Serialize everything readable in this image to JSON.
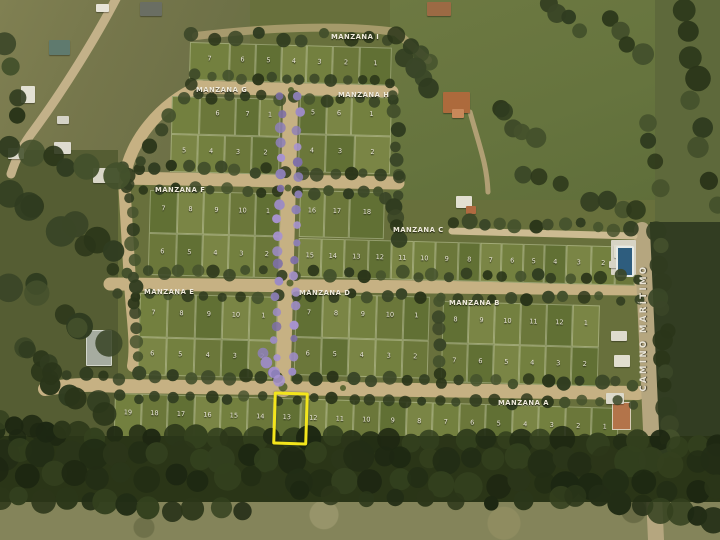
{
  "road": {
    "label": "CAMINO MARÍTIMO"
  },
  "highlight": {
    "block": "MANZANA A",
    "lot": "13",
    "color": "#F3E51C"
  },
  "palette": {
    "road": "#c6b183",
    "lawn": "#73803f",
    "trees": "#303c20",
    "flowering_trees": "#9c8bc4",
    "highlight": "#F3E51C"
  },
  "blocks": [
    {
      "name": "MANZANA A",
      "lx": 498,
      "ly": 399,
      "x": 115,
      "y": 393,
      "w": 504,
      "h": 45,
      "rot": 1.7,
      "rows": [
        {
          "y": 0,
          "h": 45,
          "cells": [
            {
              "n": "19",
              "x": 0,
              "w": 27
            },
            {
              "n": "18",
              "x": 27,
              "w": 26
            },
            {
              "n": "17",
              "x": 53,
              "w": 27
            },
            {
              "n": "16",
              "x": 80,
              "w": 26
            },
            {
              "n": "15",
              "x": 106,
              "w": 27
            },
            {
              "n": "14",
              "x": 133,
              "w": 26
            },
            {
              "n": "13",
              "x": 159,
              "w": 27,
              "hl": true
            },
            {
              "n": "12",
              "x": 186,
              "w": 26
            },
            {
              "n": "11",
              "x": 212,
              "w": 27
            },
            {
              "n": "10",
              "x": 239,
              "w": 26
            },
            {
              "n": "9",
              "x": 265,
              "w": 27
            },
            {
              "n": "8",
              "x": 292,
              "w": 26
            },
            {
              "n": "7",
              "x": 318,
              "w": 27
            },
            {
              "n": "6",
              "x": 345,
              "w": 26
            },
            {
              "n": "5",
              "x": 371,
              "w": 27
            },
            {
              "n": "4",
              "x": 398,
              "w": 26
            },
            {
              "n": "3",
              "x": 424,
              "w": 27
            },
            {
              "n": "2",
              "x": 451,
              "w": 26
            },
            {
              "n": "1",
              "x": 477,
              "w": 27
            }
          ]
        }
      ]
    },
    {
      "name": "MANZANA B",
      "lx": 449,
      "ly": 299,
      "x": 443,
      "y": 301,
      "w": 157,
      "h": 81,
      "rot": 1.6,
      "rows": [
        {
          "y": 0,
          "h": 42,
          "cells": [
            {
              "n": "8",
              "x": 0,
              "w": 26
            },
            {
              "n": "9",
              "x": 26,
              "w": 26
            },
            {
              "n": "10",
              "x": 52,
              "w": 26
            },
            {
              "n": "11",
              "x": 78,
              "w": 26
            },
            {
              "n": "12",
              "x": 104,
              "w": 26
            },
            {
              "n": "1",
              "x": 130,
              "w": 27
            }
          ]
        },
        {
          "y": 42,
          "h": 39,
          "cells": [
            {
              "n": "7",
              "x": 0,
              "w": 26
            },
            {
              "n": "6",
              "x": 26,
              "w": 26
            },
            {
              "n": "5",
              "x": 52,
              "w": 26
            },
            {
              "n": "4",
              "x": 78,
              "w": 26
            },
            {
              "n": "3",
              "x": 104,
              "w": 26
            },
            {
              "n": "2",
              "x": 130,
              "w": 27
            }
          ]
        }
      ]
    },
    {
      "name": "MANZANA C",
      "lx": 393,
      "ly": 226,
      "x": 300,
      "y": 190,
      "w": 337,
      "h": 87,
      "rot": 1.5,
      "rows": [
        {
          "y": 0,
          "h": 47,
          "cells": [
            {
              "n": "16",
              "x": 0,
              "w": 25
            },
            {
              "n": "17",
              "x": 25,
              "w": 25
            },
            {
              "n": "18",
              "x": 50,
              "w": 35
            }
          ]
        },
        {
          "y": 48,
          "h": 39,
          "cells": [
            {
              "n": "15",
              "x": 0,
              "w": 23
            },
            {
              "n": "14",
              "x": 23,
              "w": 23
            },
            {
              "n": "13",
              "x": 46,
              "w": 24
            },
            {
              "n": "12",
              "x": 70,
              "w": 23
            },
            {
              "n": "11",
              "x": 93,
              "w": 22
            },
            {
              "n": "10",
              "x": 115,
              "w": 22
            },
            {
              "n": "9",
              "x": 137,
              "w": 23
            },
            {
              "n": "8",
              "x": 160,
              "w": 22
            },
            {
              "n": "7",
              "x": 182,
              "w": 21
            },
            {
              "n": "6",
              "x": 203,
              "w": 22
            },
            {
              "n": "5",
              "x": 225,
              "w": 21
            },
            {
              "n": "4",
              "x": 246,
              "w": 22
            },
            {
              "n": "3",
              "x": 268,
              "w": 25
            },
            {
              "n": "2",
              "x": 293,
              "w": 24
            },
            {
              "n": "1",
              "x": 317,
              "w": 20
            }
          ]
        }
      ]
    },
    {
      "name": "MANZANA D",
      "lx": 299,
      "ly": 289,
      "x": 296,
      "y": 293,
      "w": 134,
      "h": 82,
      "rot": 1.6,
      "rows": [
        {
          "y": 0,
          "h": 44,
          "cells": [
            {
              "n": "7",
              "x": 0,
              "w": 27
            },
            {
              "n": "8",
              "x": 27,
              "w": 27
            },
            {
              "n": "9",
              "x": 54,
              "w": 27
            },
            {
              "n": "10",
              "x": 81,
              "w": 27
            },
            {
              "n": "1",
              "x": 108,
              "w": 26
            }
          ]
        },
        {
          "y": 44,
          "h": 38,
          "cells": [
            {
              "n": "6",
              "x": 0,
              "w": 27
            },
            {
              "n": "5",
              "x": 27,
              "w": 27
            },
            {
              "n": "4",
              "x": 54,
              "w": 27
            },
            {
              "n": "3",
              "x": 81,
              "w": 27
            },
            {
              "n": "2",
              "x": 108,
              "w": 26
            }
          ]
        }
      ]
    },
    {
      "name": "MANZANA E",
      "lx": 144,
      "ly": 288,
      "x": 140,
      "y": 293,
      "w": 138,
      "h": 82,
      "rot": 1.6,
      "rows": [
        {
          "y": 0,
          "h": 44,
          "cells": [
            {
              "n": "7",
              "x": 0,
              "w": 28
            },
            {
              "n": "8",
              "x": 28,
              "w": 28
            },
            {
              "n": "9",
              "x": 56,
              "w": 27
            },
            {
              "n": "10",
              "x": 83,
              "w": 27
            },
            {
              "n": "1",
              "x": 110,
              "w": 28
            }
          ]
        },
        {
          "y": 44,
          "h": 38,
          "cells": [
            {
              "n": "6",
              "x": 0,
              "w": 28
            },
            {
              "n": "5",
              "x": 28,
              "w": 28
            },
            {
              "n": "4",
              "x": 56,
              "w": 27
            },
            {
              "n": "3",
              "x": 83,
              "w": 27
            },
            {
              "n": "2",
              "x": 110,
              "w": 28
            }
          ]
        }
      ]
    },
    {
      "name": "MANZANA F",
      "lx": 155,
      "ly": 186,
      "x": 150,
      "y": 190,
      "w": 131,
      "h": 85,
      "rot": 1.5,
      "rows": [
        {
          "y": 0,
          "h": 43,
          "cells": [
            {
              "n": "7",
              "x": 0,
              "w": 28
            },
            {
              "n": "8",
              "x": 28,
              "w": 26
            },
            {
              "n": "9",
              "x": 54,
              "w": 26
            },
            {
              "n": "10",
              "x": 80,
              "w": 26
            },
            {
              "n": "1",
              "x": 106,
              "w": 25
            }
          ]
        },
        {
          "y": 43,
          "h": 42,
          "cells": [
            {
              "n": "6",
              "x": 0,
              "w": 28
            },
            {
              "n": "5",
              "x": 28,
              "w": 26
            },
            {
              "n": "4",
              "x": 54,
              "w": 26
            },
            {
              "n": "3",
              "x": 80,
              "w": 26
            },
            {
              "n": "2",
              "x": 106,
              "w": 25
            }
          ]
        }
      ]
    },
    {
      "name": "MANZANA G",
      "lx": 196,
      "ly": 86,
      "x": 172,
      "y": 96,
      "w": 109,
      "h": 76,
      "rot": 1.5,
      "rows": [
        {
          "y": 0,
          "h": 38,
          "cells": [
            {
              "n": "",
              "x": 0,
              "w": 28
            },
            {
              "n": "6",
              "x": 28,
              "w": 36
            },
            {
              "n": "7",
              "x": 64,
              "w": 24
            },
            {
              "n": "1",
              "x": 88,
              "w": 21
            }
          ]
        },
        {
          "y": 38,
          "h": 38,
          "cells": [
            {
              "n": "5",
              "x": 0,
              "w": 27
            },
            {
              "n": "4",
              "x": 27,
              "w": 27
            },
            {
              "n": "3",
              "x": 54,
              "w": 27
            },
            {
              "n": "2",
              "x": 81,
              "w": 28
            }
          ]
        }
      ]
    },
    {
      "name": "MANZANA H",
      "lx": 338,
      "ly": 91,
      "x": 300,
      "y": 95,
      "w": 92,
      "h": 77,
      "rot": 1.5,
      "rows": [
        {
          "y": 0,
          "h": 39,
          "cells": [
            {
              "n": "5",
              "x": 0,
              "w": 27
            },
            {
              "n": "6",
              "x": 27,
              "w": 25
            },
            {
              "n": "1",
              "x": 52,
              "w": 40
            }
          ]
        },
        {
          "y": 39,
          "h": 38,
          "cells": [
            {
              "n": "4",
              "x": 0,
              "w": 27
            },
            {
              "n": "3",
              "x": 27,
              "w": 29
            },
            {
              "n": "2",
              "x": 56,
              "w": 36
            }
          ]
        }
      ]
    },
    {
      "name": "MANZANA I",
      "lx": 331,
      "ly": 33,
      "x": 190,
      "y": 42,
      "w": 202,
      "h": 38,
      "rot": 1.6,
      "rows": [
        {
          "y": 0,
          "h": 38,
          "cells": [
            {
              "n": "7",
              "x": 0,
              "w": 40
            },
            {
              "n": "6",
              "x": 40,
              "w": 26
            },
            {
              "n": "5",
              "x": 66,
              "w": 26
            },
            {
              "n": "4",
              "x": 92,
              "w": 25
            },
            {
              "n": "3",
              "x": 117,
              "w": 26
            },
            {
              "n": "2",
              "x": 143,
              "w": 27
            },
            {
              "n": "1",
              "x": 170,
              "w": 32
            }
          ]
        }
      ]
    }
  ]
}
